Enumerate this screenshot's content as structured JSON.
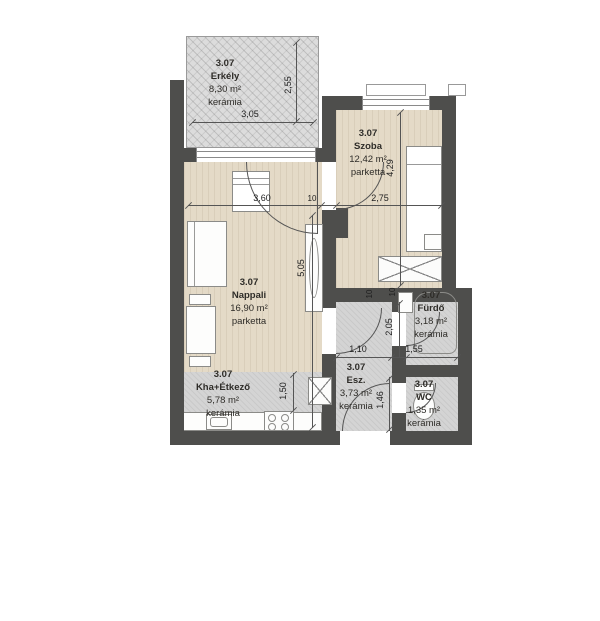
{
  "rooms": {
    "erkely": {
      "number": "3.07",
      "name": "Erkély",
      "area": "8,30 m²",
      "floor": "kerámia"
    },
    "szoba": {
      "number": "3.07",
      "name": "Szoba",
      "area": "12,42 m²",
      "floor": "parketta"
    },
    "nappali": {
      "number": "3.07",
      "name": "Nappali",
      "area": "16,90 m²",
      "floor": "parketta"
    },
    "konyha": {
      "number": "3.07",
      "name": "Kha+Étkező",
      "area": "5,78 m²",
      "floor": "kerámia"
    },
    "esz": {
      "number": "3.07",
      "name": "Esz.",
      "area": "3,73 m²",
      "floor": "kerámia"
    },
    "furdo": {
      "number": "3.07",
      "name": "Fürdő",
      "area": "3,18 m²",
      "floor": "kerámia"
    },
    "wc": {
      "number": "3.07",
      "name": "WC",
      "area": "1,35 m²",
      "floor": "kerámia"
    }
  },
  "dims": {
    "d305": "3,05",
    "d255": "2,55",
    "d360": "3,60",
    "d275": "2,75",
    "d505": "5,05",
    "d429": "4,29",
    "d110": "1,10",
    "d205": "2,05",
    "d155": "1,55",
    "d146": "1,46",
    "d150": "1,50",
    "t10a": "10",
    "t10b": "10",
    "t10c": "10"
  },
  "colors": {
    "wall": "#4e4e4c",
    "parquet": "#e4dac7",
    "ceramic": "#d4d4d4",
    "balcony": "#dcdcdc",
    "line": "#555555"
  }
}
